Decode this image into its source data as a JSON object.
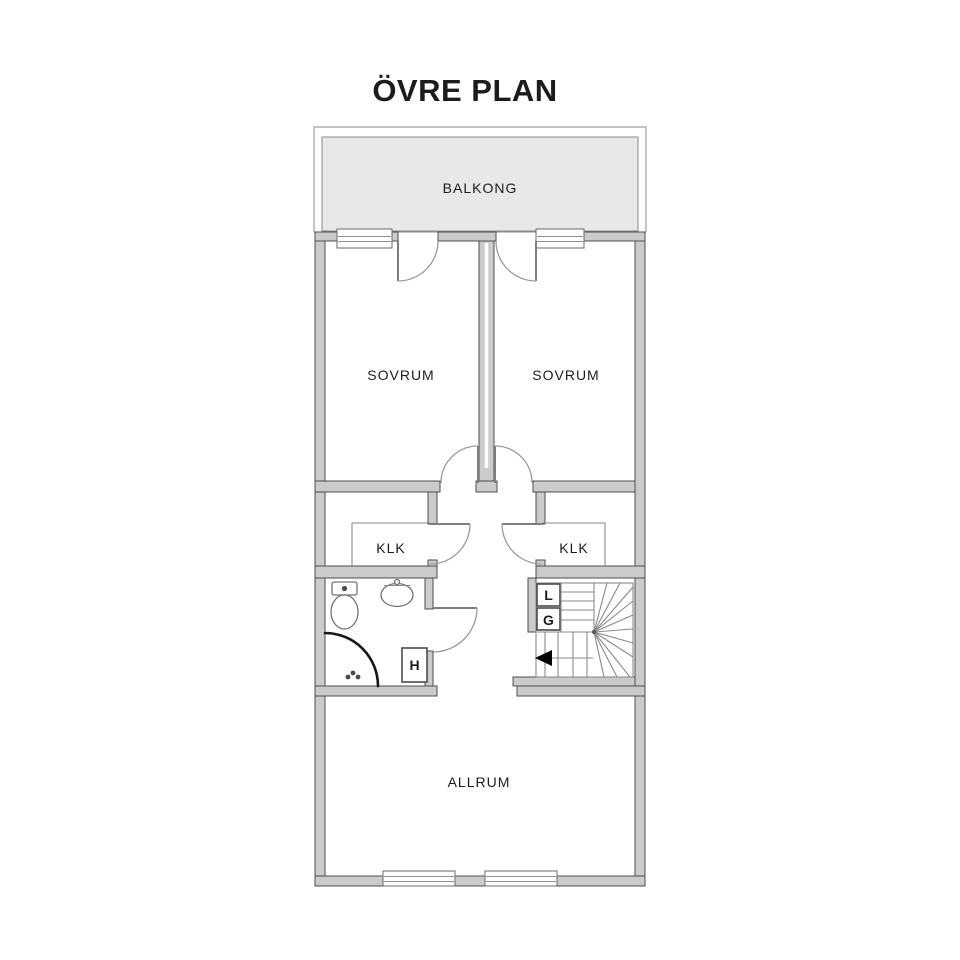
{
  "title": "ÖVRE PLAN",
  "rooms": {
    "balcony": "BALKONG",
    "bedroom_left": "SOVRUM",
    "bedroom_right": "SOVRUM",
    "closet_left": "KLK",
    "closet_right": "KLK",
    "living_room": "ALLRUM"
  },
  "labels": {
    "stair_cabinet_l": "L",
    "stair_cabinet_g": "G",
    "bathroom_cabinet_h": "H"
  },
  "colors": {
    "wall_fill": "#cbcbcb",
    "wall_stroke": "#4d4d4d",
    "balcony_fill": "#e8e8e8",
    "thin_line": "#8a8a8a",
    "text": "#1c1c1c"
  }
}
